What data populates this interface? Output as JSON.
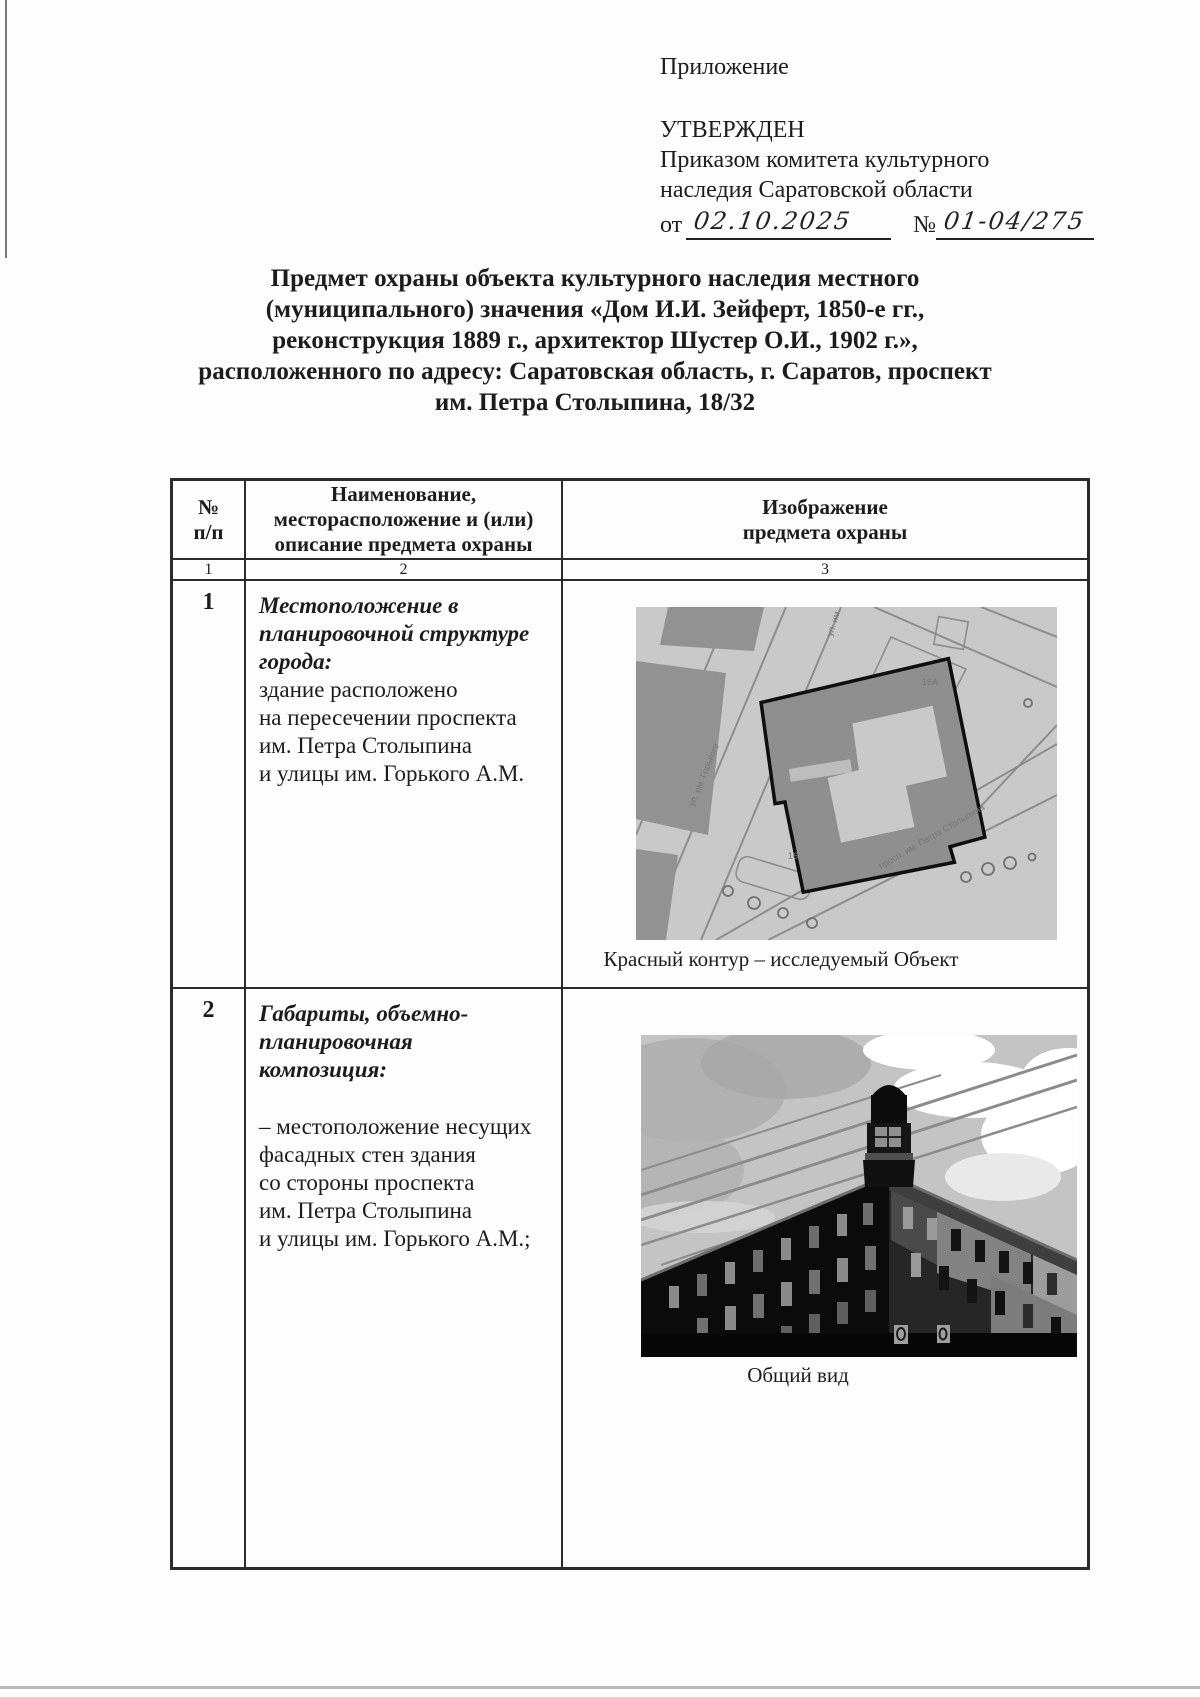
{
  "approval": {
    "appendix_label": "Приложение",
    "approved_label": "УТВЕРЖДЕН",
    "approved_by_line1": "Приказом комитета культурного",
    "approved_by_line2": "наследия Саратовской области",
    "date_prefix": "от",
    "date_value": "02.10.2025",
    "number_sign": "№",
    "number_value": "01-04/275"
  },
  "title": {
    "lines": [
      "Предмет охраны объекта культурного наследия местного",
      "(муниципального) значения «Дом И.И. Зейферт, 1850-е гг.,",
      "реконструкция 1889 г., архитектор Шустер О.И., 1902 г.»,",
      "расположенного по адресу: Саратовская область, г. Саратов, проспект",
      "им. Петра Столыпина, 18/32"
    ]
  },
  "table": {
    "header": {
      "col1": "№\nп/п",
      "col2": "Наименование,\nместорасположение и (или)\nописание предмета охраны",
      "col3": "Изображение\nпредмета охраны"
    },
    "column_numbers": [
      "1",
      "2",
      "3"
    ],
    "rows": [
      {
        "num": "1",
        "heading": "Местоположение в\nпланировочной структуре\nгорода:",
        "body": "здание расположено\nна пересечении проспекта\nим. Петра Столыпина\nи улицы им. Горького А.М.",
        "caption": "Красный контур – исследуемый Объект"
      },
      {
        "num": "2",
        "heading": "Габариты, объемно-\nпланировочная\nкомпозиция:",
        "body": "– местоположение несущих\nфасадных стен здания\nсо стороны проспекта\nим. Петра Столыпина\nи улицы им. Горького А.М.;",
        "caption": "Общий вид"
      }
    ]
  },
  "map_labels": {
    "street_top": "ул. им.",
    "street_left": "ул. им. Горького",
    "street_bottom": "просп. им. Петра Столыпина",
    "parcel_a": "16А",
    "parcel_b": "16"
  },
  "colors": {
    "ink": "#1c1c1c",
    "map_bg": "#c9c9c9",
    "map_building": "#929292",
    "contour": "#0f0f0f",
    "photo_sky": "#c4c4c4"
  }
}
